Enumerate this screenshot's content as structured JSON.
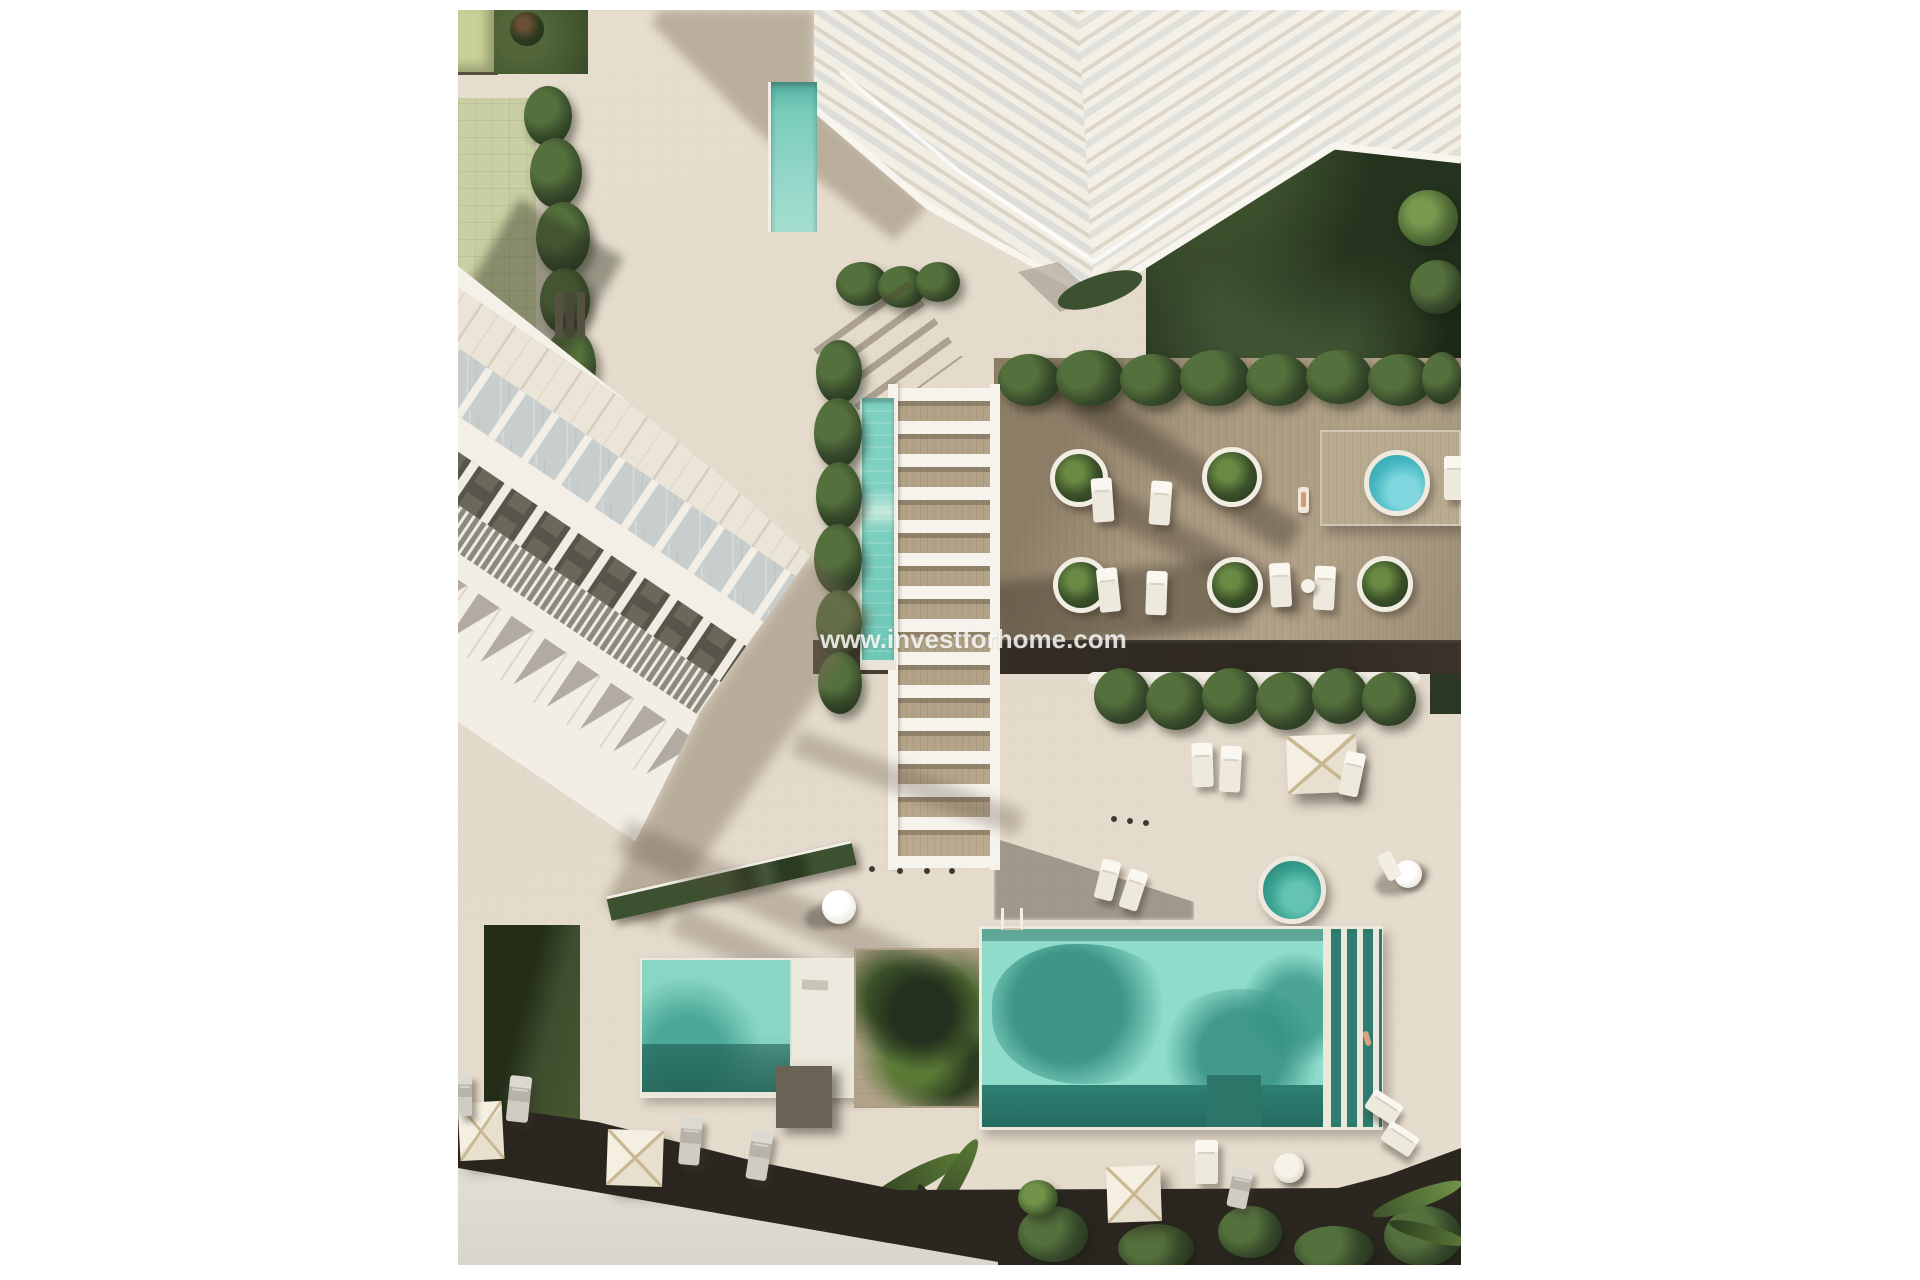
{
  "watermark": {
    "text": "www.investforhome.com"
  },
  "palette": {
    "page_background": "#ffffff",
    "pavement": "#e3dacb",
    "deck_wood": "#a8997f",
    "dark_walkway": "#332d24",
    "pool_water": "#8fdccb",
    "pool_water_shadow": "#2f8276",
    "spa_water": "#45b7c0",
    "lawn_green": "#3e4d2e",
    "hedge_green": "#36492a",
    "playground_paving": "#c9cfa2",
    "building_white": "#f2eee5",
    "balcony_gray": "#575449",
    "road_gray": "#d9d5cd",
    "umbrella_canvas": "#efe9da"
  },
  "scene": {
    "type": "aerial-architectural-render",
    "elements": [
      "apartment-tower",
      "townhouse-row",
      "playground",
      "pergola-walkway",
      "lap-pool",
      "sun-deck",
      "round-planters",
      "deck-spa-pool",
      "plaza-spa-pool",
      "main-pool",
      "kids-pool",
      "swim-lanes",
      "palm-trees",
      "sun-loungers",
      "square-parasols",
      "garden",
      "road",
      "watermark"
    ]
  }
}
